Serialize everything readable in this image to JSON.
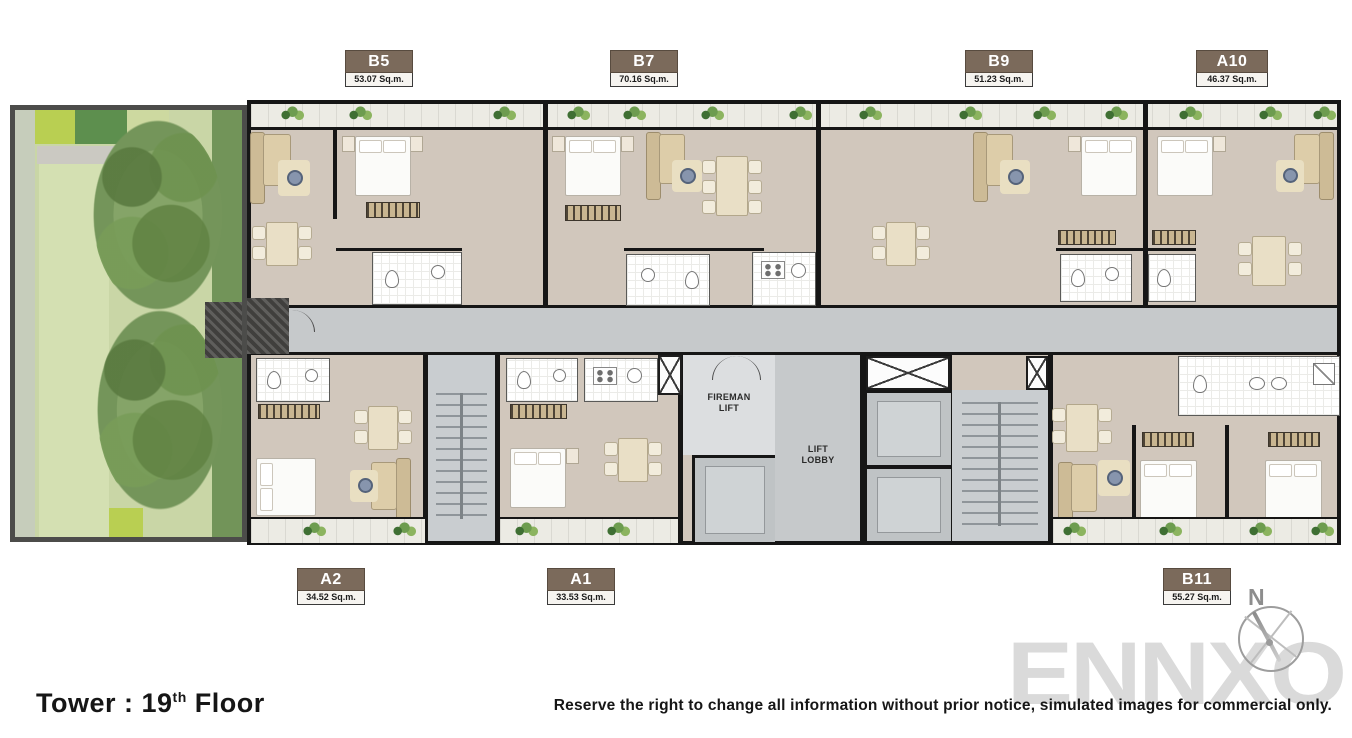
{
  "title": {
    "text_main": "Tower : 19",
    "superscript": "th",
    "text_tail": " Floor"
  },
  "disclaimer": "Reserve the right to change all information without prior notice, simulated images for commercial only.",
  "watermark": "ENNXO",
  "compass": {
    "north_label": "N"
  },
  "core_labels": {
    "fireman_line1": "FIREMAN",
    "fireman_line2": "LIFT",
    "lobby_line1": "LIFT",
    "lobby_line2": "LOBBY"
  },
  "units": [
    {
      "id": "B5",
      "area": "53.07 Sq.m.",
      "row": "top"
    },
    {
      "id": "B7",
      "area": "70.16 Sq.m.",
      "row": "top"
    },
    {
      "id": "B9",
      "area": "51.23 Sq.m.",
      "row": "top"
    },
    {
      "id": "A10",
      "area": "46.37 Sq.m.",
      "row": "top"
    },
    {
      "id": "A2",
      "area": "34.52 Sq.m.",
      "row": "bottom"
    },
    {
      "id": "A1",
      "area": "33.53 Sq.m.",
      "row": "bottom"
    },
    {
      "id": "B11",
      "area": "55.27 Sq.m.",
      "row": "bottom"
    }
  ],
  "colors": {
    "label_brown": "#7b6a5b",
    "floor_beige": "#d1c7bc",
    "corridor_gray": "#c6c9cb",
    "wall_black": "#161616",
    "garden_green": "#c9d6a6",
    "watermark_gray": "#dadada"
  }
}
